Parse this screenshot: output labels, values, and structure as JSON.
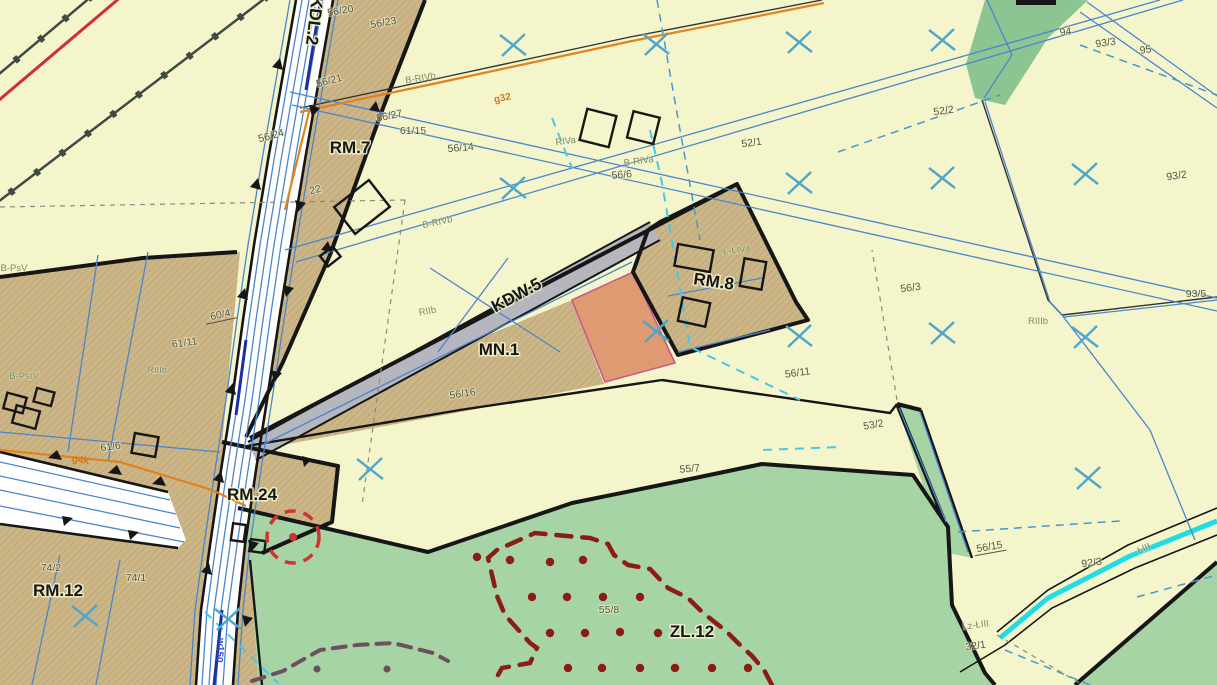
{
  "map": {
    "colors": {
      "background": "#f5f5cb",
      "zone_tan": "#ccb687",
      "zone_green": "#a6d4a4",
      "zone_green_dark": "#8cc492",
      "road_white": "#ffffff",
      "road_gray": "#b6b6bf",
      "highlight_parcel_orange": "#e09a72",
      "parcel_line_blue": "#4a86cc",
      "grid_cross_blue": "#4ea6cc",
      "stream_cyan": "#22dce4",
      "forest_boundary_maroon": "#8b1d15",
      "gas_line_orange": "#e2821c",
      "rail_line_red": "#cf3030",
      "monument_circle_red": "#d03333",
      "boundary_black": "#161616"
    },
    "zone_labels": [
      {
        "text": "KDL.2",
        "x": 309,
        "y": 20,
        "rot": 97
      },
      {
        "text": "RM.7",
        "x": 350,
        "y": 153,
        "rot": 0
      },
      {
        "text": "KDW.5",
        "x": 519,
        "y": 300,
        "rot": -28
      },
      {
        "text": "MN.1",
        "x": 499,
        "y": 355,
        "rot": 0
      },
      {
        "text": "RM.8",
        "x": 713,
        "y": 287,
        "rot": 8
      },
      {
        "text": "RM.24",
        "x": 252,
        "y": 500,
        "rot": 0
      },
      {
        "text": "RM.12",
        "x": 58,
        "y": 596,
        "rot": 0
      },
      {
        "text": "ZL.12",
        "x": 692,
        "y": 637,
        "rot": 0
      }
    ],
    "parcel_labels": [
      {
        "text": "56/20",
        "x": 341,
        "y": 14,
        "rot": -10
      },
      {
        "text": "56/23",
        "x": 384,
        "y": 26,
        "rot": -10
      },
      {
        "text": "56/21",
        "x": 330,
        "y": 84,
        "rot": -15
      },
      {
        "text": "56/27",
        "x": 390,
        "y": 119,
        "rot": -12
      },
      {
        "text": "61/15",
        "x": 413,
        "y": 134,
        "rot": 0
      },
      {
        "text": "56/24",
        "x": 272,
        "y": 139,
        "rot": -15
      },
      {
        "text": "56/14",
        "x": 461,
        "y": 151,
        "rot": -5
      },
      {
        "text": "22",
        "x": 316,
        "y": 193,
        "rot": -15
      },
      {
        "text": "56/6",
        "x": 622,
        "y": 178,
        "rot": -5
      },
      {
        "text": "52/1",
        "x": 752,
        "y": 146,
        "rot": -8
      },
      {
        "text": "52/2",
        "x": 944,
        "y": 114,
        "rot": -8
      },
      {
        "text": "94",
        "x": 1066,
        "y": 35,
        "rot": -8
      },
      {
        "text": "93/3",
        "x": 1106,
        "y": 46,
        "rot": -8
      },
      {
        "text": "95",
        "x": 1146,
        "y": 53,
        "rot": -8
      },
      {
        "text": "93/2",
        "x": 1177,
        "y": 179,
        "rot": -8
      },
      {
        "text": "93/5",
        "x": 1196,
        "y": 297,
        "rot": 0
      },
      {
        "text": "56/3",
        "x": 911,
        "y": 291,
        "rot": -8
      },
      {
        "text": "60/4",
        "x": 221,
        "y": 318,
        "rot": -12,
        "underline": true
      },
      {
        "text": "61/11",
        "x": 185,
        "y": 346,
        "rot": -8
      },
      {
        "text": "61/6",
        "x": 111,
        "y": 450,
        "rot": -8
      },
      {
        "text": "56/16",
        "x": 463,
        "y": 397,
        "rot": -8
      },
      {
        "text": "56/11",
        "x": 798,
        "y": 376,
        "rot": -8
      },
      {
        "text": "53/2",
        "x": 874,
        "y": 428,
        "rot": -10
      },
      {
        "text": "55/7",
        "x": 690,
        "y": 472,
        "rot": -5
      },
      {
        "text": "55/8",
        "x": 609,
        "y": 613,
        "rot": 0
      },
      {
        "text": "74/2",
        "x": 51,
        "y": 571,
        "rot": 0
      },
      {
        "text": "74/1",
        "x": 136,
        "y": 581,
        "rot": 0
      },
      {
        "text": "56/15",
        "x": 990,
        "y": 550,
        "rot": -10,
        "underline": true
      },
      {
        "text": "92/3",
        "x": 1092,
        "y": 566,
        "rot": -8
      },
      {
        "text": "32/1",
        "x": 976,
        "y": 649,
        "rot": -8
      }
    ],
    "soil_labels": [
      {
        "text": "B-PsV",
        "x": 14,
        "y": 271,
        "rot": 0
      },
      {
        "text": "B-RIVb",
        "x": 421,
        "y": 81,
        "rot": -10
      },
      {
        "text": "B-RIVb",
        "x": 438,
        "y": 225,
        "rot": -12
      },
      {
        "text": "RIVa",
        "x": 566,
        "y": 144,
        "rot": -8
      },
      {
        "text": "B-RIVa",
        "x": 639,
        "y": 164,
        "rot": -8
      },
      {
        "text": "Ł-ŁIVa",
        "x": 737,
        "y": 253,
        "rot": -8
      },
      {
        "text": "RIIb",
        "x": 428,
        "y": 314,
        "rot": -10
      },
      {
        "text": "RIIIb",
        "x": 157,
        "y": 373,
        "rot": 0
      },
      {
        "text": "B-PsIV",
        "x": 24,
        "y": 379,
        "rot": 0
      },
      {
        "text": "RIIIb",
        "x": 1038,
        "y": 324,
        "rot": 0
      },
      {
        "text": "Lz-ŁIII",
        "x": 976,
        "y": 628,
        "rot": -8
      },
      {
        "text": "ŁIII",
        "x": 1145,
        "y": 551,
        "rot": -25
      }
    ],
    "utility_labels": [
      {
        "text": "g32",
        "x": 503,
        "y": 101,
        "rot": -12,
        "cls": "gas"
      },
      {
        "text": "g4k",
        "x": 80,
        "y": 463,
        "rot": 8,
        "cls": "gas"
      },
      {
        "text": "w150",
        "x": 217,
        "y": 650,
        "rot": 95,
        "cls": "water"
      }
    ],
    "symbols": {
      "grid_crosses": [
        [
          513,
          45
        ],
        [
          656,
          44
        ],
        [
          799,
          42
        ],
        [
          942,
          40
        ],
        [
          513,
          188
        ],
        [
          799,
          183
        ],
        [
          942,
          178
        ],
        [
          1085,
          174
        ],
        [
          656,
          331
        ],
        [
          799,
          336
        ],
        [
          942,
          333
        ],
        [
          1085,
          337
        ],
        [
          370,
          469
        ],
        [
          1088,
          478
        ],
        [
          228,
          619
        ],
        [
          85,
          616
        ]
      ],
      "forest_dots": [
        [
          477,
          557
        ],
        [
          510,
          560
        ],
        [
          550,
          562
        ],
        [
          583,
          560
        ],
        [
          532,
          597
        ],
        [
          567,
          597
        ],
        [
          603,
          597
        ],
        [
          640,
          597
        ],
        [
          550,
          633
        ],
        [
          585,
          633
        ],
        [
          620,
          632
        ],
        [
          658,
          633
        ],
        [
          568,
          668
        ],
        [
          602,
          668
        ],
        [
          640,
          668
        ],
        [
          675,
          668
        ],
        [
          712,
          668
        ],
        [
          748,
          668
        ]
      ],
      "boundary_dots": [
        [
          317,
          669
        ],
        [
          387,
          669
        ]
      ],
      "monument_circle": {
        "x": 293,
        "y": 537,
        "r": 26
      }
    }
  }
}
